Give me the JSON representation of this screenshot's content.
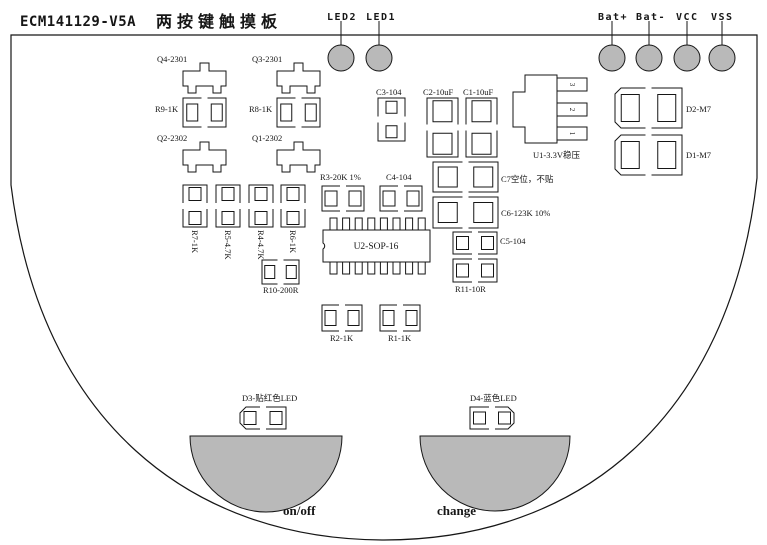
{
  "title": {
    "code": "ECM141129-V5A",
    "name": "两按键触摸板"
  },
  "colors": {
    "line": "#161616",
    "pad_fill": "#b9b9b9",
    "bg": "#ffffff"
  },
  "top_pins": [
    {
      "id": "LED2",
      "label": "LED2",
      "cx": 341,
      "cy": 58,
      "lx": 327,
      "ly": 20
    },
    {
      "id": "LED1",
      "label": "LED1",
      "cx": 379,
      "cy": 58,
      "lx": 366,
      "ly": 20
    },
    {
      "id": "Bat-plus",
      "label": "Bat+",
      "cx": 612,
      "cy": 58,
      "lx": 598,
      "ly": 20
    },
    {
      "id": "Bat-minus",
      "label": "Bat-",
      "cx": 649,
      "cy": 58,
      "lx": 636,
      "ly": 20
    },
    {
      "id": "VCC",
      "label": "VCC",
      "cx": 687,
      "cy": 58,
      "lx": 676,
      "ly": 20
    },
    {
      "id": "VSS",
      "label": "VSS",
      "cx": 722,
      "cy": 58,
      "lx": 711,
      "ly": 20
    }
  ],
  "components": [
    {
      "id": "Q4",
      "type": "sot23",
      "label": "Q4-2301",
      "x": 183,
      "y": 71,
      "lx": 157,
      "ly": 62
    },
    {
      "id": "Q3",
      "type": "sot23",
      "label": "Q3-2301",
      "x": 277,
      "y": 71,
      "lx": 252,
      "ly": 62
    },
    {
      "id": "R9",
      "type": "fp",
      "orient": "h",
      "label": "R9-1K",
      "x": 183,
      "y": 98,
      "w": 43,
      "h": 29,
      "pw": 11,
      "ph": 17,
      "lx": 155,
      "ly": 112
    },
    {
      "id": "R8",
      "type": "fp",
      "orient": "h",
      "label": "R8-1K",
      "x": 277,
      "y": 98,
      "w": 43,
      "h": 29,
      "pw": 11,
      "ph": 17,
      "lx": 249,
      "ly": 112
    },
    {
      "id": "Q2",
      "type": "sot23",
      "label": "Q2-2302",
      "x": 183,
      "y": 150,
      "lx": 157,
      "ly": 141
    },
    {
      "id": "Q1",
      "type": "sot23",
      "label": "Q1-2302",
      "x": 277,
      "y": 150,
      "lx": 252,
      "ly": 141
    },
    {
      "id": "C3",
      "type": "fp",
      "orient": "v",
      "label": "C3-104",
      "x": 378,
      "y": 98,
      "w": 27,
      "h": 43,
      "pw": 11,
      "ph": 12,
      "lx": 376,
      "ly": 95
    },
    {
      "id": "C2",
      "type": "fp",
      "orient": "v",
      "label": "C2-10uF",
      "x": 427,
      "y": 98,
      "w": 31,
      "h": 59,
      "pw": 19,
      "ph": 21,
      "lx": 423,
      "ly": 95
    },
    {
      "id": "C1",
      "type": "fp",
      "orient": "v",
      "label": "C1-10uF",
      "x": 466,
      "y": 98,
      "w": 31,
      "h": 59,
      "pw": 19,
      "ph": 21,
      "lx": 463,
      "ly": 95
    },
    {
      "id": "C7",
      "type": "fp",
      "orient": "h",
      "label": "C7空位，不贴",
      "x": 433,
      "y": 162,
      "w": 65,
      "h": 30,
      "pw": 19,
      "ph": 20,
      "lx": 501,
      "ly": 182
    },
    {
      "id": "C6",
      "type": "fp",
      "orient": "h",
      "label": "C6-123K 10%",
      "x": 433,
      "y": 197,
      "w": 65,
      "h": 31,
      "pw": 19,
      "ph": 20,
      "lx": 501,
      "ly": 216
    },
    {
      "id": "C5",
      "type": "fp",
      "orient": "h",
      "label": "C5-104",
      "x": 453,
      "y": 232,
      "w": 44,
      "h": 22,
      "pw": 12,
      "ph": 13,
      "lx": 500,
      "ly": 244
    },
    {
      "id": "R11",
      "type": "fp",
      "orient": "h",
      "label": "R11-10R",
      "x": 453,
      "y": 259,
      "w": 44,
      "h": 23,
      "pw": 12,
      "ph": 13,
      "lx": 455,
      "ly": 292
    },
    {
      "id": "R3",
      "type": "fp",
      "orient": "h",
      "label": "R3-20K 1%",
      "x": 322,
      "y": 186,
      "w": 42,
      "h": 25,
      "pw": 12,
      "ph": 15,
      "lx": 320,
      "ly": 180
    },
    {
      "id": "C4",
      "type": "fp",
      "orient": "h",
      "label": "C4-104",
      "x": 380,
      "y": 186,
      "w": 42,
      "h": 25,
      "pw": 12,
      "ph": 15,
      "lx": 386,
      "ly": 180
    },
    {
      "id": "R7",
      "type": "fp",
      "orient": "v",
      "label": "R7-1K",
      "x": 183,
      "y": 185,
      "w": 24,
      "h": 42,
      "pw": 12,
      "ph": 13,
      "lx": 192,
      "ly": 230,
      "lrot": 90
    },
    {
      "id": "R5",
      "type": "fp",
      "orient": "v",
      "label": "R5-4.7K",
      "x": 216,
      "y": 185,
      "w": 24,
      "h": 42,
      "pw": 12,
      "ph": 13,
      "lx": 225,
      "ly": 230,
      "lrot": 90
    },
    {
      "id": "R4",
      "type": "fp",
      "orient": "v",
      "label": "R4-4.7K",
      "x": 249,
      "y": 185,
      "w": 24,
      "h": 42,
      "pw": 12,
      "ph": 13,
      "lx": 258,
      "ly": 230,
      "lrot": 90
    },
    {
      "id": "R6",
      "type": "fp",
      "orient": "v",
      "label": "R6-1K",
      "x": 281,
      "y": 185,
      "w": 24,
      "h": 42,
      "pw": 12,
      "ph": 13,
      "lx": 290,
      "ly": 230,
      "lrot": 90
    },
    {
      "id": "R10",
      "type": "fp",
      "orient": "h",
      "label": "R10-200R",
      "x": 262,
      "y": 260,
      "w": 37,
      "h": 24,
      "pw": 10,
      "ph": 13,
      "lx": 263,
      "ly": 293
    },
    {
      "id": "R2",
      "type": "fp",
      "orient": "h",
      "label": "R2-1K",
      "x": 322,
      "y": 305,
      "w": 40,
      "h": 26,
      "pw": 11,
      "ph": 15,
      "lx": 330,
      "ly": 341
    },
    {
      "id": "R1",
      "type": "fp",
      "orient": "h",
      "label": "R1-1K",
      "x": 380,
      "y": 305,
      "w": 40,
      "h": 26,
      "pw": 11,
      "ph": 15,
      "lx": 388,
      "ly": 341
    },
    {
      "id": "D2",
      "type": "fp",
      "orient": "h",
      "chamfer": "left",
      "label": "D2-M7",
      "x": 615,
      "y": 88,
      "w": 67,
      "h": 40,
      "pw": 18,
      "ph": 27,
      "lx": 686,
      "ly": 112
    },
    {
      "id": "D1",
      "type": "fp",
      "orient": "h",
      "chamfer": "left",
      "label": "D1-M7",
      "x": 615,
      "y": 135,
      "w": 67,
      "h": 40,
      "pw": 18,
      "ph": 27,
      "lx": 686,
      "ly": 158
    },
    {
      "id": "D3",
      "type": "fp",
      "orient": "h",
      "chamfer": "left",
      "label": "D3-贴红色LED",
      "x": 240,
      "y": 407,
      "w": 46,
      "h": 22,
      "pw": 12,
      "ph": 13,
      "lx": 242,
      "ly": 401
    },
    {
      "id": "D4",
      "type": "fp",
      "orient": "h",
      "chamfer": "right",
      "label": "D4-蓝色LED",
      "x": 470,
      "y": 407,
      "w": 44,
      "h": 22,
      "pw": 12,
      "ph": 12,
      "lx": 470,
      "ly": 401
    },
    {
      "id": "U1",
      "type": "reg",
      "label": "U1-3.3V稳压",
      "pin_labels": [
        "3",
        "2",
        "1"
      ],
      "x": 513,
      "y": 75,
      "lx": 533,
      "ly": 158
    },
    {
      "id": "U2",
      "type": "sop16",
      "label": "U2-SOP-16",
      "x": 323,
      "y": 230,
      "w": 107,
      "h": 32,
      "lx": 376,
      "ly": 249
    }
  ],
  "touch_pads": [
    {
      "id": "onoff",
      "label": "on/off",
      "x1": 190,
      "x2": 342,
      "y": 436,
      "r": 76,
      "lx": 283,
      "ly": 515
    },
    {
      "id": "change",
      "label": "change",
      "x1": 420,
      "x2": 570,
      "y": 436,
      "r": 75,
      "lx": 437,
      "ly": 515
    }
  ]
}
